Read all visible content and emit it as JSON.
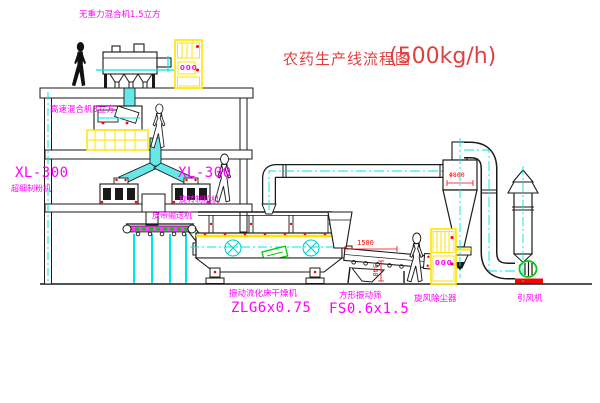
{
  "title": {
    "text": "农药生产线流程图",
    "capacity": "(500kg/h)"
  },
  "equipment": {
    "gravity_mixer": {
      "label": "无重力混合机1.5立方"
    },
    "high_speed_mixer": {
      "label": "高速混合机3立方"
    },
    "mill": {
      "model": "XL-300",
      "name": "超细制粉机"
    },
    "granulator": {
      "model": "XL-300",
      "name": "旋转制粒机"
    },
    "belt_conveyor": {
      "name": "皮带输送机"
    },
    "fluid_bed_dryer": {
      "name": "振动流化床干燥机",
      "model": "ZLG6x0.75"
    },
    "vibrating_sieve": {
      "name": "方形振动筛",
      "model": "FS0.6x1.5"
    },
    "cyclone": {
      "name": "旋风除尘器",
      "dimension": "Φ800"
    },
    "fan": {
      "name": "引风机"
    }
  },
  "dimensions": {
    "sieve_length": "1500",
    "sieve_height": "340"
  },
  "control_panels": {
    "top": "000",
    "bottom": "000"
  },
  "colors": {
    "label": "#ff00ff",
    "title": "#e04040",
    "dimension": "#ff0000",
    "centerline": "#00e5e5",
    "frame_yellow": "#ffe400",
    "pipe_fill": "#66e8e8",
    "green": "#00cc00",
    "line": "#1a1a1a"
  }
}
